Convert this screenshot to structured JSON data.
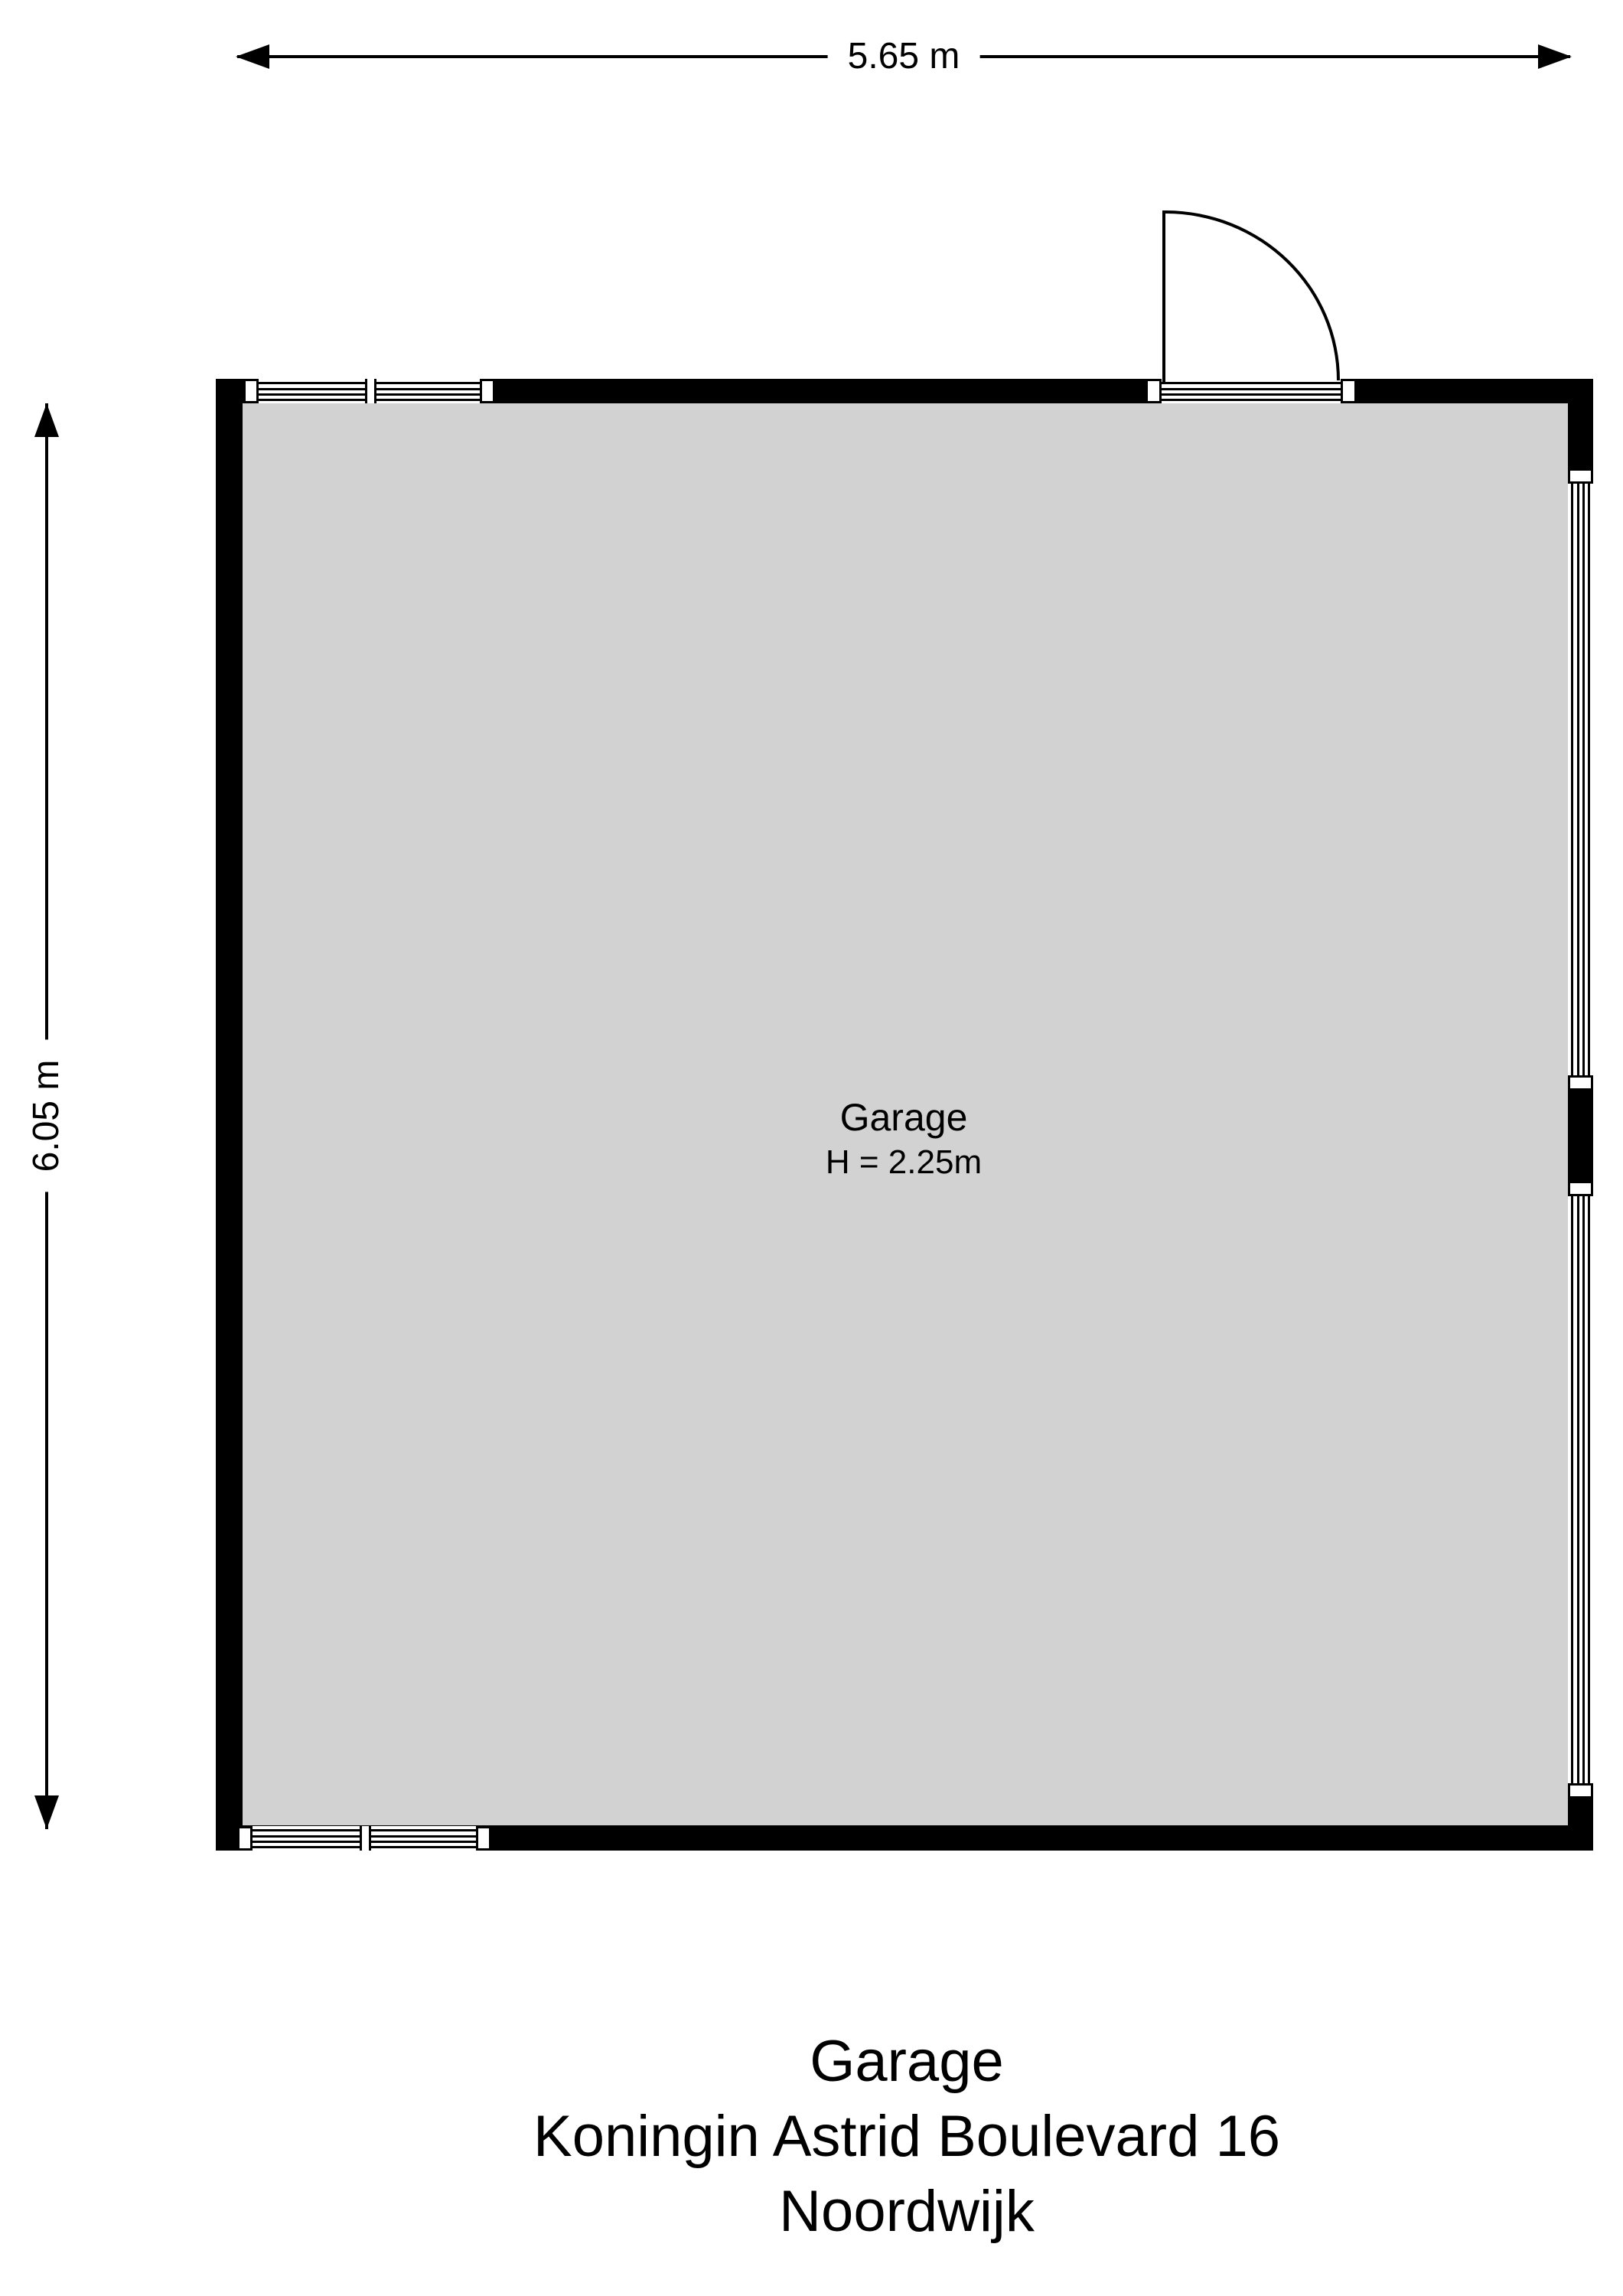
{
  "plan": {
    "dimensions": {
      "width_label": "5.65 m",
      "height_label": "6.05 m"
    },
    "room": {
      "name": "Garage",
      "ceiling_height": "H = 2.25m"
    }
  },
  "caption": {
    "title": "Garage",
    "address": "Koningin Astrid Boulevard 16",
    "city": "Noordwijk"
  },
  "colors": {
    "wall": "#000000",
    "floor_fill": "#d2d2d2",
    "line": "#000000",
    "background": "#ffffff"
  }
}
